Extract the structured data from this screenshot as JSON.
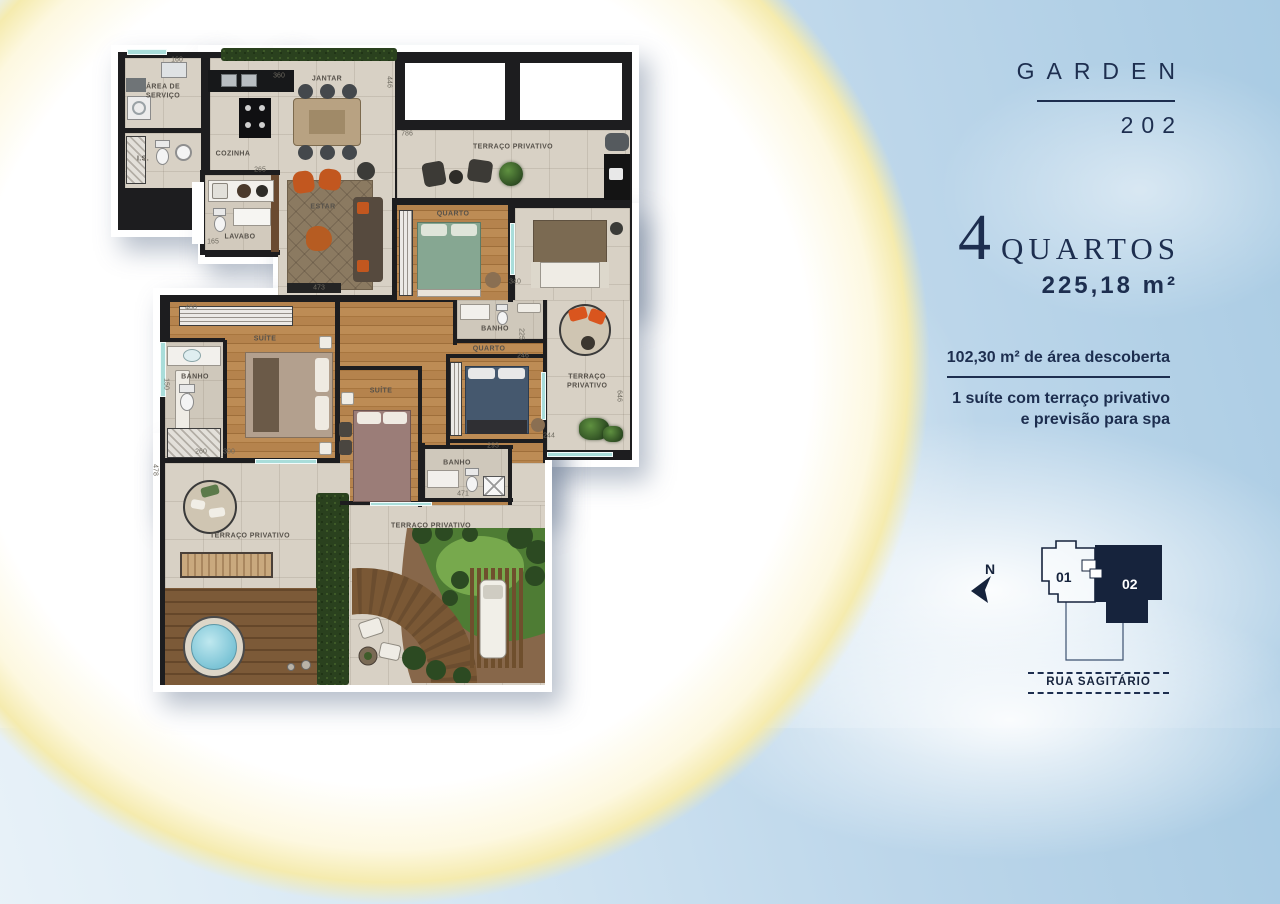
{
  "colors": {
    "navy": "#1d2e4f",
    "navy_dark": "#16233c",
    "teal_window": "#a9ddda"
  },
  "panel": {
    "title": "GARDEN",
    "unit_number": "202",
    "bedrooms_number": "4",
    "bedrooms_label": "QUARTOS",
    "total_area": "225,18 m²",
    "uncovered_area": "102,30 m² de área descoberta",
    "feature_line1": "1 suíte com terraço privativo",
    "feature_line2": "e previsão para spa",
    "compass_label": "N",
    "keyplan_unit01": "01",
    "keyplan_unit02": "02",
    "street_name": "RUA SAGITÁRIO"
  },
  "plan": {
    "labels": {
      "area_servico": "ÁREA DE SERVIÇO",
      "is": "I.S.",
      "cozinha": "COZINHA",
      "jantar": "JANTAR",
      "lavabo": "LAVABO",
      "estar": "ESTAR",
      "terraco": "TERRAÇO PRIVATIVO",
      "quarto": "QUARTO",
      "suite": "SUÍTE",
      "banho": "BANHO"
    },
    "dimensions": [
      {
        "v": "160",
        "x": 64,
        "y": 20,
        "r": 0
      },
      {
        "v": "360",
        "x": 166,
        "y": 36,
        "r": 0
      },
      {
        "v": "446",
        "x": 276,
        "y": 42,
        "r": 1
      },
      {
        "v": "786",
        "x": 294,
        "y": 94,
        "r": 0
      },
      {
        "v": "265",
        "x": 147,
        "y": 130,
        "r": 0
      },
      {
        "v": "165",
        "x": 100,
        "y": 202,
        "r": 0
      },
      {
        "v": "473",
        "x": 206,
        "y": 248,
        "r": 0
      },
      {
        "v": "460",
        "x": 78,
        "y": 268,
        "r": 0
      },
      {
        "v": "150",
        "x": 53,
        "y": 344,
        "r": 1
      },
      {
        "v": "260",
        "x": 88,
        "y": 412,
        "r": 0
      },
      {
        "v": "300",
        "x": 116,
        "y": 412,
        "r": 0
      },
      {
        "v": "478",
        "x": 42,
        "y": 430,
        "r": 1
      },
      {
        "v": "340",
        "x": 402,
        "y": 242,
        "r": 0
      },
      {
        "v": "225",
        "x": 408,
        "y": 294,
        "r": 1
      },
      {
        "v": "246",
        "x": 410,
        "y": 316,
        "r": 0
      },
      {
        "v": "293",
        "x": 380,
        "y": 406,
        "r": 0
      },
      {
        "v": "244",
        "x": 436,
        "y": 396,
        "r": 0
      },
      {
        "v": "646",
        "x": 506,
        "y": 356,
        "r": 1
      },
      {
        "v": "471",
        "x": 350,
        "y": 454,
        "r": 0
      }
    ]
  }
}
